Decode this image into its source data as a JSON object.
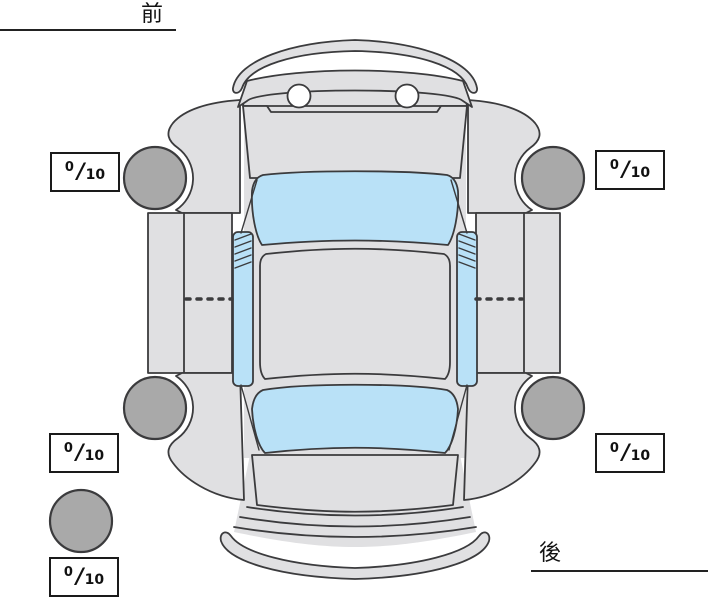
{
  "labels": {
    "front": "前",
    "rear": "後"
  },
  "fraction_slash": "/",
  "tread_scores": [
    {
      "id": "front-left",
      "value": "0",
      "max": "10"
    },
    {
      "id": "front-right",
      "value": "0",
      "max": "10"
    },
    {
      "id": "rear-left",
      "value": "0",
      "max": "10"
    },
    {
      "id": "rear-right",
      "value": "0",
      "max": "10"
    },
    {
      "id": "spare",
      "value": "0",
      "max": "10"
    }
  ],
  "colors": {
    "background": "#ffffff",
    "car_body": "#e0e0e2",
    "glass": "#b9e1f7",
    "tire": "#a9a9a9",
    "outline": "#3b3b3d",
    "box_border": "#1a1a1a"
  }
}
